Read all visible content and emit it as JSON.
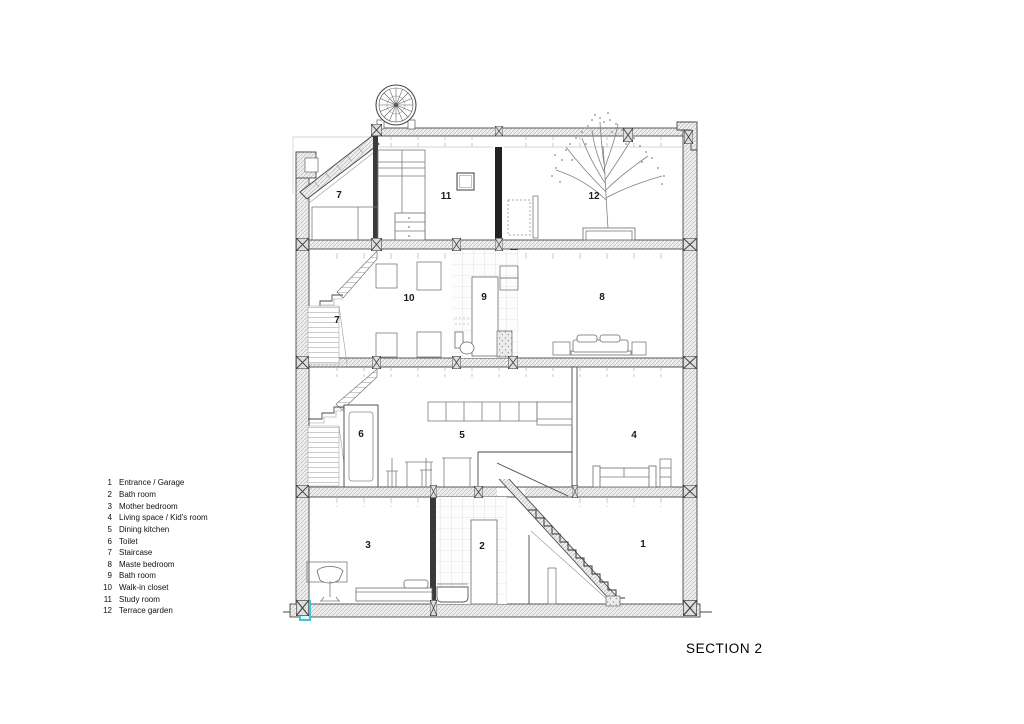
{
  "drawing": {
    "title": "SECTION 2",
    "legend": {
      "items": [
        {
          "num": "1",
          "label": "Entrance / Garage"
        },
        {
          "num": "2",
          "label": "Bath room"
        },
        {
          "num": "3",
          "label": "Mother bedroom"
        },
        {
          "num": "4",
          "label": "Living space / Kid's room"
        },
        {
          "num": "5",
          "label": "Dining kitchen"
        },
        {
          "num": "6",
          "label": "Toilet"
        },
        {
          "num": "7",
          "label": "Staircase"
        },
        {
          "num": "8",
          "label": "Maste bedroom"
        },
        {
          "num": "9",
          "label": "Bath room"
        },
        {
          "num": "10",
          "label": "Walk-in closet"
        },
        {
          "num": "11",
          "label": "Study room"
        },
        {
          "num": "12",
          "label": "Terrace garden"
        }
      ]
    },
    "room_labels": {
      "staircase_top": "7",
      "study": "11",
      "terrace": "12",
      "staircase_mid": "7",
      "walkin": "10",
      "bath_upper": "9",
      "master": "8",
      "toilet": "6",
      "dining": "5",
      "living": "4",
      "mother": "3",
      "bath_lower": "2",
      "entrance": "1"
    },
    "colors": {
      "accent_cyan": "#3EC6D8",
      "line": "#4A4A4A"
    }
  }
}
